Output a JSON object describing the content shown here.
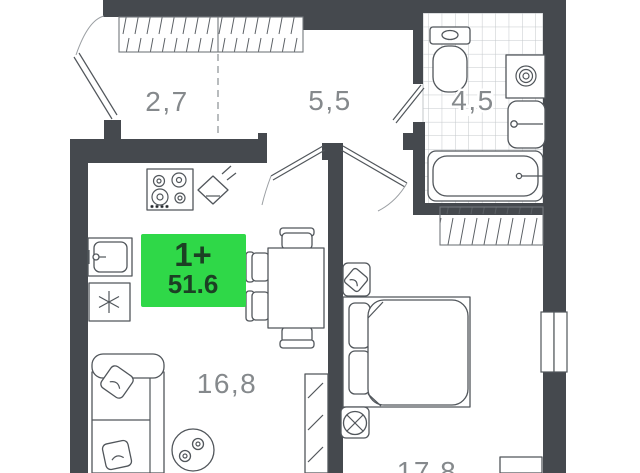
{
  "plan": {
    "badge": {
      "rooms": "1+",
      "area": "51.6"
    },
    "labels": {
      "balcony": "2,7",
      "hallway": "5,5",
      "bathroom": "4,5",
      "living": "16,8",
      "bedroom": "17,8"
    },
    "colors": {
      "wall": "#45494e",
      "furniture_line": "#51565b",
      "tile_grid": "#c3c7ca",
      "hatch_line": "#5a5f64",
      "label_text": "#85898c",
      "dash_line": "#9b9fa3",
      "badge_bg": "#2fd848",
      "badge_text": "#1c4024",
      "background": "#ffffff"
    }
  }
}
